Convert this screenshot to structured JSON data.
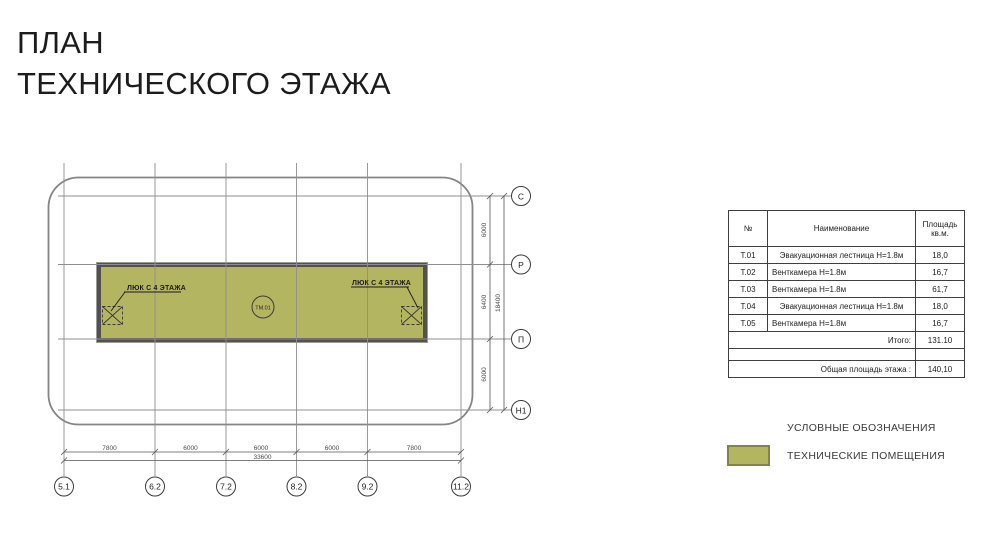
{
  "title": {
    "line1": "ПЛАН",
    "line2": "ТЕХНИЧЕСКОГО ЭТАЖА"
  },
  "plan": {
    "room_tag": "ТМ.01",
    "hatch_label": "ЛЮК С 4 ЭТАЖА",
    "axes_bottom": [
      "5.1",
      "6.2",
      "7.2",
      "8.2",
      "9.2",
      "11.2"
    ],
    "axes_right": [
      "С",
      "Р",
      "П",
      "Н1"
    ],
    "dims_bottom": [
      "7800",
      "6000",
      "6000",
      "6000",
      "7800"
    ],
    "dim_bottom_total": "33600",
    "dims_right": [
      "6000",
      "6400",
      "6000"
    ],
    "dim_right_total": "18400",
    "room_fill_color": "#b4b560",
    "room_border_color": "#52524b",
    "grid_color": "#8f8f8f"
  },
  "table": {
    "headers": {
      "num": "№",
      "name": "Наименование",
      "area_line1": "Площадь",
      "area_line2": "кв.м."
    },
    "rows": [
      {
        "num": "Т.01",
        "name": "Эвакуационная лестница Н=1.8м",
        "area": "18,0"
      },
      {
        "num": "Т.02",
        "name": "Венткамера Н=1.8м",
        "area": "16,7"
      },
      {
        "num": "Т.03",
        "name": "Венткамера Н=1.8м",
        "area": "61,7"
      },
      {
        "num": "Т.04",
        "name": "Эвакуационная лестница Н=1.8м",
        "area": "18,0"
      },
      {
        "num": "Т.05",
        "name": "Венткамера Н=1.8м",
        "area": "16,7"
      }
    ],
    "total": {
      "label": "Итого:",
      "value": "131.10"
    },
    "overall": {
      "label": "Общая площадь этажа :",
      "value": "140,10"
    }
  },
  "legend": {
    "title": "УСЛОВНЫЕ ОБОЗНАЧЕНИЯ",
    "item": "ТЕХНИЧЕСКИЕ ПОМЕЩЕНИЯ",
    "swatch_color": "#b4b560"
  }
}
